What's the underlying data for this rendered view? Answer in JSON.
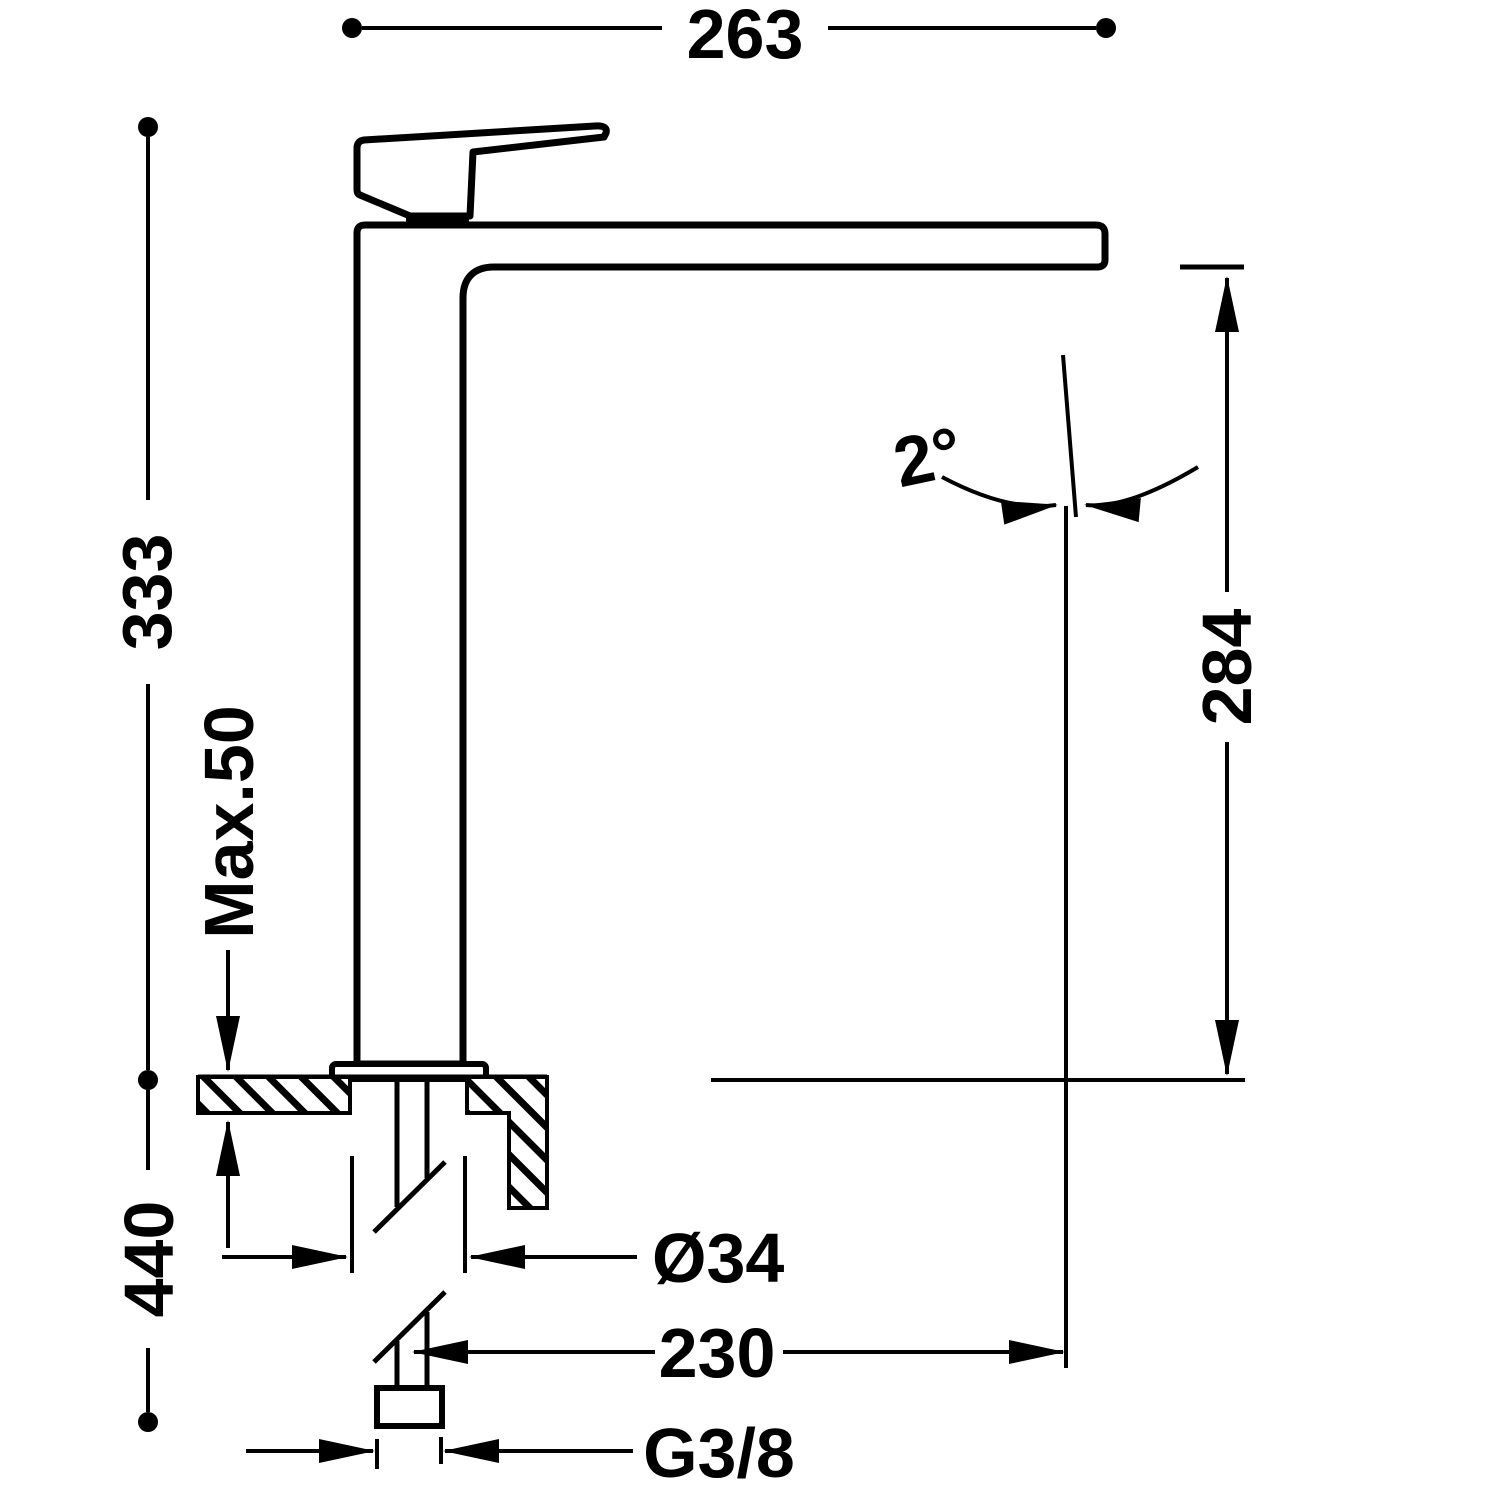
{
  "drawing": {
    "kind": "technical dimension drawing",
    "subject": "single-lever tall vessel basin mixer, side elevation with installation dimensions",
    "background_color": "#ffffff",
    "line_color": "#000000"
  },
  "labels": {
    "overall_width": "263",
    "height_above_counter": "333",
    "max_counter_thickness": "Max.50",
    "total_height_below": "440",
    "spout_tilt_angle": "2°",
    "spout_outlet_height": "284",
    "mounting_hole_diameter": "Ø34",
    "spout_projection": "230",
    "supply_connection_thread": "G3/8"
  }
}
